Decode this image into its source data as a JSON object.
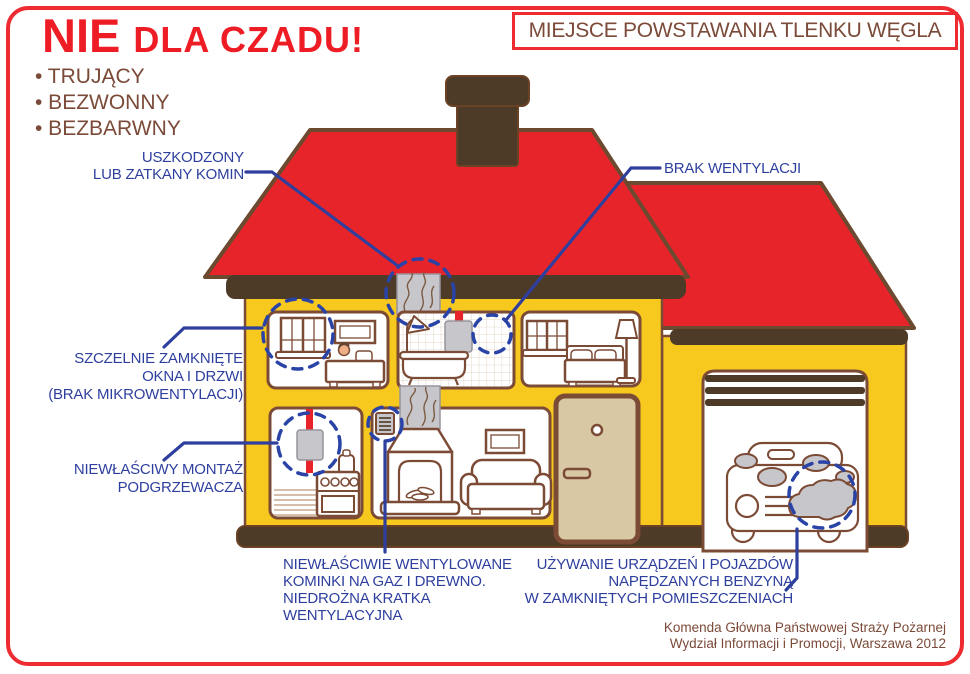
{
  "poster": {
    "title_no": "NIE",
    "title_rest": "DLA CZADU!",
    "header_box": "MIEJSCE POWSTAWANIA TLENKU WĘGLA",
    "bullets": [
      "• TRUJĄCY",
      "• BEZWONNY",
      "• BEZBARWNY"
    ]
  },
  "labels": {
    "chimney": {
      "lines": [
        "USZKODZONY",
        "LUB ZATKANY KOMIN"
      ]
    },
    "no_ventilation": {
      "lines": [
        "BRAK WENTYLACJI"
      ]
    },
    "sealed_windows": {
      "lines": [
        "SZCZELNIE ZAMKNIĘTE",
        "OKNA I DRZWI",
        "(BRAK MIKROWENTYLACJI)"
      ]
    },
    "heater": {
      "lines": [
        "NIEWŁAŚCIWY MONTAŻ",
        "PODGRZEWACZA"
      ]
    },
    "fireplace": {
      "lines": [
        "NIEWŁAŚCIWIE WENTYLOWANE",
        "KOMINKI NA GAZ I DREWNO.",
        "NIEDROŻNA KRATKA",
        "WENTYLACYJNA"
      ]
    },
    "garage": {
      "lines": [
        "UŻYWANIE URZĄDZEŃ I POJAZDÓW",
        "NAPĘDZANYCH BENZYNĄ",
        "W ZAMKNIĘTYCH POMIESZCZENIACH"
      ]
    }
  },
  "footer": {
    "lines": [
      "Komenda Główna Państwowej Straży Pożarnej",
      "Wydział Informacji i Promocji, Warszawa 2012"
    ]
  },
  "colors": {
    "accent_red": "#ee1c24",
    "roof_red": "#e8242b",
    "wall_yellow": "#f7c81e",
    "dark_brown": "#4d3a27",
    "outline_brown": "#7c4b36",
    "label_blue": "#2e3f9e",
    "smoke_gray": "#c7c6cb",
    "door_beige": "#d8c8a4",
    "text_brown": "#7b4a38"
  }
}
